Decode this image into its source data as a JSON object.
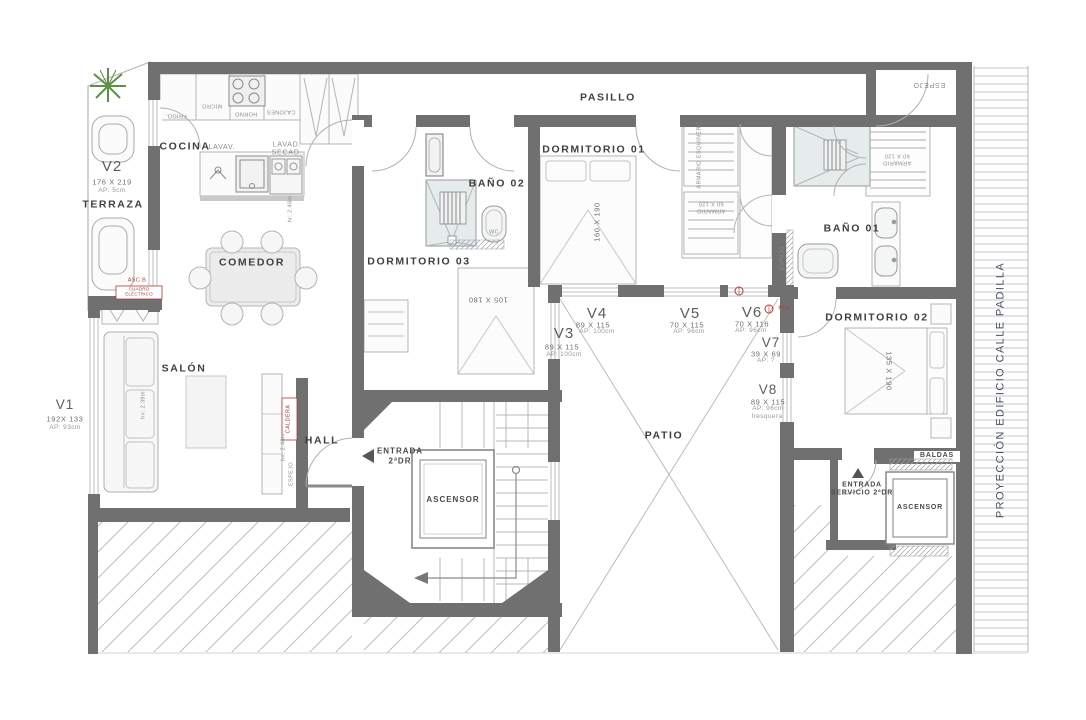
{
  "rooms": {
    "terraza": "TERRAZA",
    "cocina": "COCINA",
    "comedor": "COMEDOR",
    "salon": "SALÓN",
    "hall": "HALL",
    "pasillo": "PASILLO",
    "patio": "PATIO",
    "dormitorio_01": "DORMITORIO 01",
    "dormitorio_02": "DORMITORIO 02",
    "dormitorio_03": "DORMITORIO 03",
    "bano_01": "BAÑO 01",
    "bano_02": "BAÑO 02",
    "ascensor": "ASCENSOR",
    "ascensor_servicio": "ASCENSOR"
  },
  "windows": {
    "v1": {
      "id": "V1",
      "size": "192X 133",
      "ap": "AP: 93cm"
    },
    "v2": {
      "id": "V2",
      "size": "176 X 219",
      "ap": "AP: 5cm"
    },
    "v3": {
      "id": "V3",
      "size": "89 X 115",
      "ap": "AP: 100cm"
    },
    "v4": {
      "id": "V4",
      "size": "89 X 115",
      "ap": "AP: 100cm"
    },
    "v5": {
      "id": "V5",
      "size": "70 X 115",
      "ap": "AP: 96cm"
    },
    "v6": {
      "id": "V6",
      "size": "70 X 116",
      "ap": "AP: 96cm"
    },
    "v7": {
      "id": "V7",
      "size": "39 X 69",
      "ap": "AP: ?"
    },
    "v8": {
      "id": "V8",
      "size": "89 X 115",
      "ap": "AP: 96cm",
      "note": "fresquera"
    }
  },
  "fixtures": {
    "frigo": "FRIGO.",
    "micro": "MICRO.",
    "horno": "HORNO",
    "cajones": "CAJONES",
    "lavav": "LAVAV.",
    "lavad_secad": "LAVAD.\nSECAD.",
    "wc": "WC",
    "caldera": "CALDERA",
    "cuadro_electrico": "CUADRO\nELÉCTRICO",
    "asc_b": "ASC.B",
    "plv": "PLV",
    "baldas": "BALDAS",
    "espejo_entrada": "ESPEJO",
    "espejo_pared": "ESPEJO",
    "espejo_hall": "ESPEJO",
    "armario_esquinero": "ARMARIO ESQUINERO",
    "armario_60x120": "ARMARIO\n60 X 120",
    "armario_60x120_b": "ARMARIO\n60 X 120",
    "cama_dorm01": "160 X 190",
    "cama_dorm02": "135 X 190",
    "cama_dorm03": "105 X 180"
  },
  "annotations": {
    "entrada_principal": "ENTRADA\n2ªDR",
    "entrada_servicio": "ENTRADA\nSERVICIO 2ªDR",
    "proyeccion": "PROYECCIÓN EDIFICIO CALLE PADILLA",
    "altura_salon": "hv: 2.39m",
    "altura_cocina": "hr: 2.48m",
    "altura_hall": "hv: 2.48m"
  },
  "colors": {
    "wall": "#707070",
    "accent_red": "#b03a2e",
    "plant_green": "#5e8f46",
    "band_text": "#4a5160"
  }
}
